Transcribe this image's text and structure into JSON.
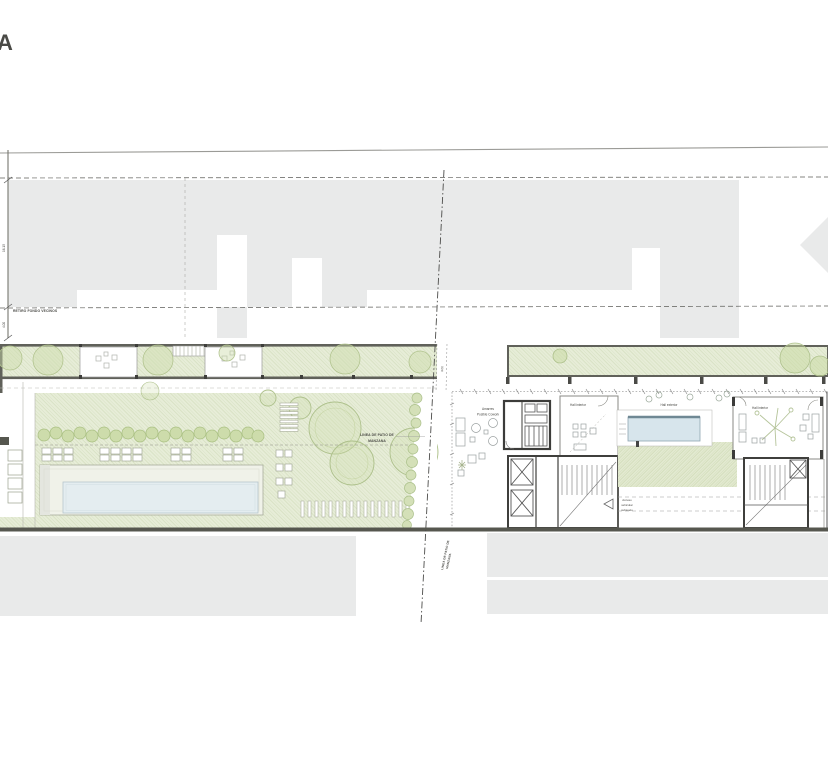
{
  "title": {
    "fragment": "A"
  },
  "labels": {
    "retiro_fondo": "RETIRO FONDO VECINOS",
    "patio_line1": "LINEA DE PATIO DE",
    "patio_line2": "MANZANA",
    "amarres1": "Amarres",
    "amarres2": "Posible Cowork",
    "hall_interior_left": "Hall interior",
    "hall_exterior": "Hall exterior",
    "hall_interior_right": "Hall interior",
    "acceso1": "Acceso",
    "acceso2": "vehicular",
    "acceso3": "subsuelo"
  },
  "dims": {
    "left_upper": "16.15",
    "left_lower": "4.00",
    "gap": "3.00"
  },
  "colors": {
    "context_gray": "#e9eaea",
    "green_fill": "#e7edd8",
    "green_hatch_line": "#ccd8b2",
    "vegetation": "#cddcab",
    "tree_stroke": "#aec18c",
    "pool_water": "#e4edf0",
    "water_feature": "#d7e5ec",
    "wall_dark": "#3c3c3a",
    "site_border": "#56574f",
    "dash_line": "#4c4c4a"
  }
}
